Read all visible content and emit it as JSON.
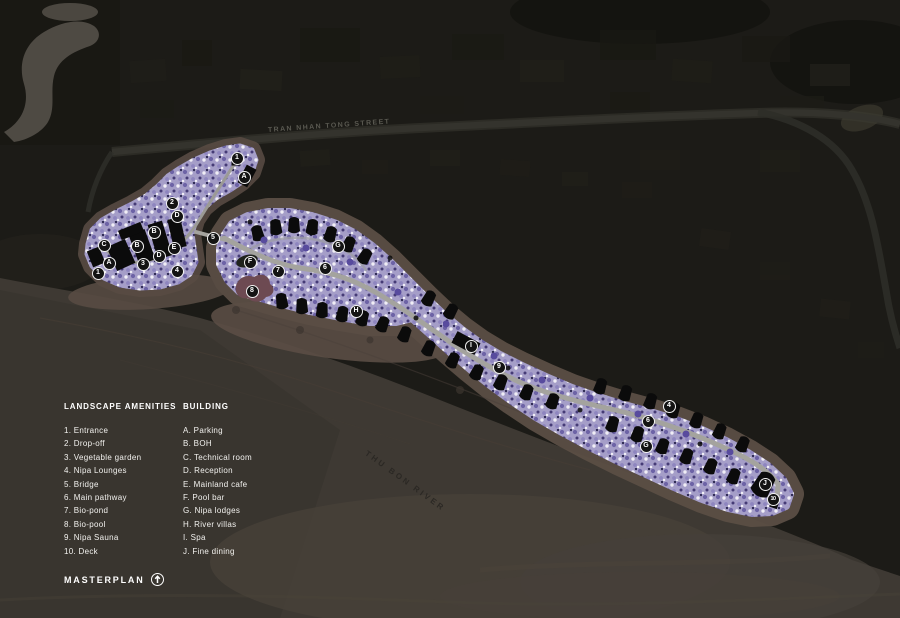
{
  "colors": {
    "background": "#1c1b17",
    "text": "#ffffff",
    "street_label": "#5a5951",
    "river_label": "#2b2824",
    "river": "#3e3933",
    "sand_ring": "#5b4e45",
    "vegetation_lavender": "#a59ec8",
    "vegetation_purple": "#6d63a6",
    "pathway": "#a4a39e",
    "building": "#0b0b0b",
    "bio_pool": "#6d4a52"
  },
  "map": {
    "street_label": "TRAN NHAN TONG STREET",
    "river_label": "THU BON RIVER",
    "markers": [
      {
        "label": "1",
        "x": 237,
        "y": 158
      },
      {
        "label": "A",
        "x": 244,
        "y": 177
      },
      {
        "label": "2",
        "x": 172,
        "y": 203
      },
      {
        "label": "D",
        "x": 177,
        "y": 216
      },
      {
        "label": "B",
        "x": 154,
        "y": 232
      },
      {
        "label": "5",
        "x": 213,
        "y": 238
      },
      {
        "label": "C",
        "x": 104,
        "y": 245
      },
      {
        "label": "B",
        "x": 137,
        "y": 246
      },
      {
        "label": "E",
        "x": 174,
        "y": 248
      },
      {
        "label": "D",
        "x": 159,
        "y": 256
      },
      {
        "label": "A",
        "x": 109,
        "y": 263
      },
      {
        "label": "3",
        "x": 143,
        "y": 264
      },
      {
        "label": "4",
        "x": 177,
        "y": 271
      },
      {
        "label": "1",
        "x": 98,
        "y": 273
      },
      {
        "label": "F",
        "x": 250,
        "y": 262
      },
      {
        "label": "7",
        "x": 278,
        "y": 271
      },
      {
        "label": "8",
        "x": 252,
        "y": 291
      },
      {
        "label": "6",
        "x": 325,
        "y": 268
      },
      {
        "label": "G",
        "x": 338,
        "y": 246
      },
      {
        "label": "H",
        "x": 356,
        "y": 311
      },
      {
        "label": "I",
        "x": 471,
        "y": 346
      },
      {
        "label": "9",
        "x": 499,
        "y": 367
      },
      {
        "label": "4",
        "x": 669,
        "y": 406
      },
      {
        "label": "6",
        "x": 648,
        "y": 421
      },
      {
        "label": "G",
        "x": 646,
        "y": 446
      },
      {
        "label": "J",
        "x": 765,
        "y": 484
      },
      {
        "label": "10",
        "x": 773,
        "y": 499
      }
    ]
  },
  "legend": {
    "amenities": {
      "header": "LANDSCAPE AMENITIES",
      "items": [
        "1. Entrance",
        "2. Drop-off",
        "3. Vegetable garden",
        "4. Nipa Lounges",
        "5. Bridge",
        "6. Main pathway",
        "7. Bio-pond",
        "8. Bio-pool",
        "9. Nipa Sauna",
        "10. Deck"
      ]
    },
    "building": {
      "header": "BUILDING",
      "items": [
        "A. Parking",
        "B. BOH",
        "C. Technical room",
        "D. Reception",
        "E. Mainland cafe",
        "F. Pool bar",
        "G. Nipa lodges",
        "H. River villas",
        "I. Spa",
        "J. Fine dining"
      ]
    }
  },
  "footer": {
    "title": "MASTERPLAN",
    "north_icon": "north-arrow-icon"
  }
}
